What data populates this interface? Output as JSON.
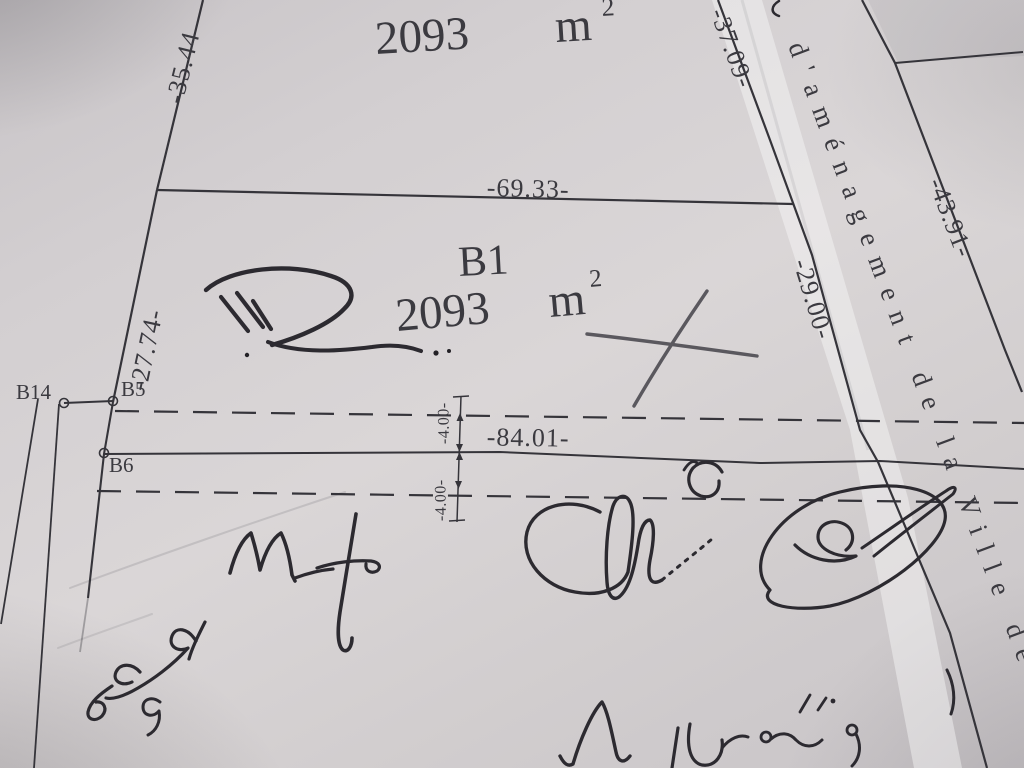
{
  "plan": {
    "upper_parcel": {
      "area_num": "2093",
      "area_unit": "m",
      "area_exp": "2"
    },
    "parcel": {
      "id": "B1",
      "area_num": "2093",
      "area_unit": "m",
      "area_exp": "2"
    },
    "points": {
      "b14": "B14",
      "b5": "B5",
      "b6": "B6"
    },
    "dims": {
      "d3544": "-35.44",
      "d6933": "-69.33-",
      "d2774": "-27.74-",
      "d3709": "-37.09-",
      "d2900": "-29.00-",
      "d4391": "-43.91-",
      "d8401": "-84.01-",
      "d400_upper": "-4.00-",
      "d400_lower": "-4.00-"
    },
    "road_text": "d'aménagement de la Ville de",
    "colors": {
      "paper": "#d6d2d4",
      "ink": "#3b3a40",
      "pencil": "#5a585e",
      "pen": "#2c2a30"
    }
  }
}
